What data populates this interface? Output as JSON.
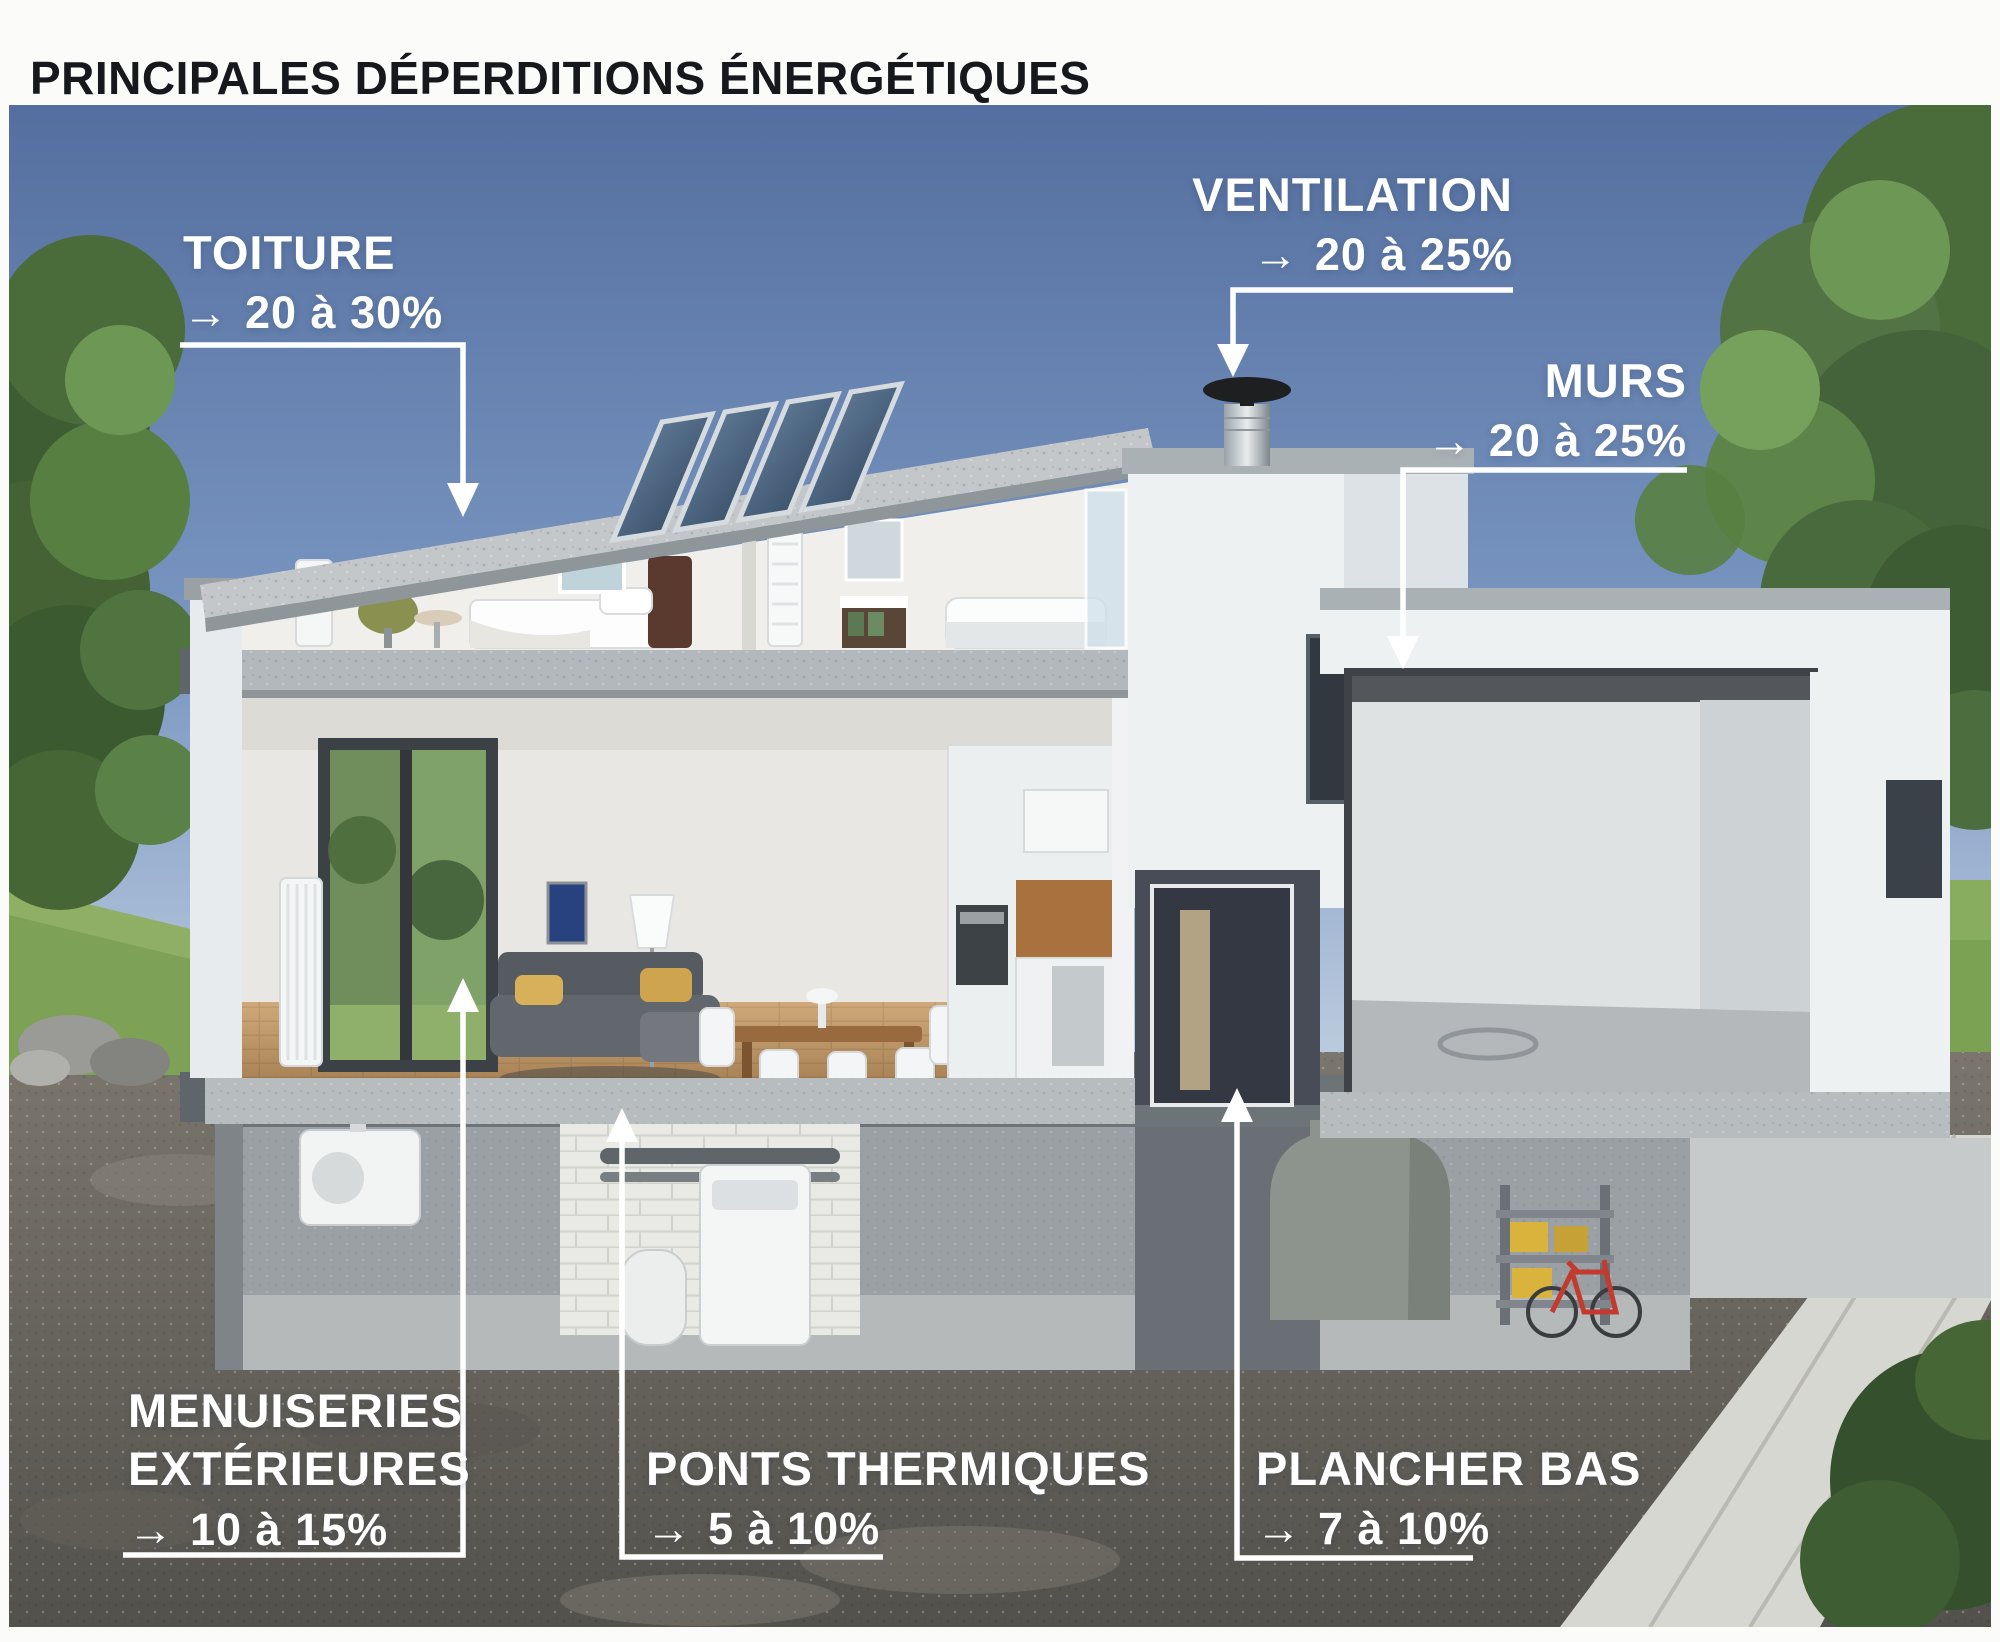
{
  "title": "PRINCIPALES DÉPERDITIONS ÉNERGÉTIQUES",
  "labels": [
    {
      "id": "toiture",
      "name": "TOITURE",
      "arrow": "→",
      "value": "20 à 30%"
    },
    {
      "id": "ventilation",
      "name": "VENTILATION",
      "arrow": "→",
      "value": "20 à 25%"
    },
    {
      "id": "murs",
      "name": "MURS",
      "arrow": "→",
      "value": "20 à 25%"
    },
    {
      "id": "menuiseries-exterieures",
      "name": "MENUISERIES EXTÉRIEURES",
      "arrow": "→",
      "value": "10 à 15%"
    },
    {
      "id": "ponts-thermiques",
      "name": "PONTS THERMIQUES",
      "arrow": "→",
      "value": "5 à 10%"
    },
    {
      "id": "plancher-bas",
      "name": "PLANCHER BAS",
      "arrow": "→",
      "value": "7 à 10%"
    }
  ],
  "colors": {
    "title_text": "#16181c",
    "label_text": "#ffffff",
    "leader_line": "#ffffff",
    "sky_top": "#546f9f",
    "sky_bottom": "#c2d2e2",
    "wall_white": "#eef1f2",
    "concrete": "#b2b8bb",
    "soil": "#6e6a62",
    "grass": "#7da155",
    "solar_panel": "#31465c"
  }
}
